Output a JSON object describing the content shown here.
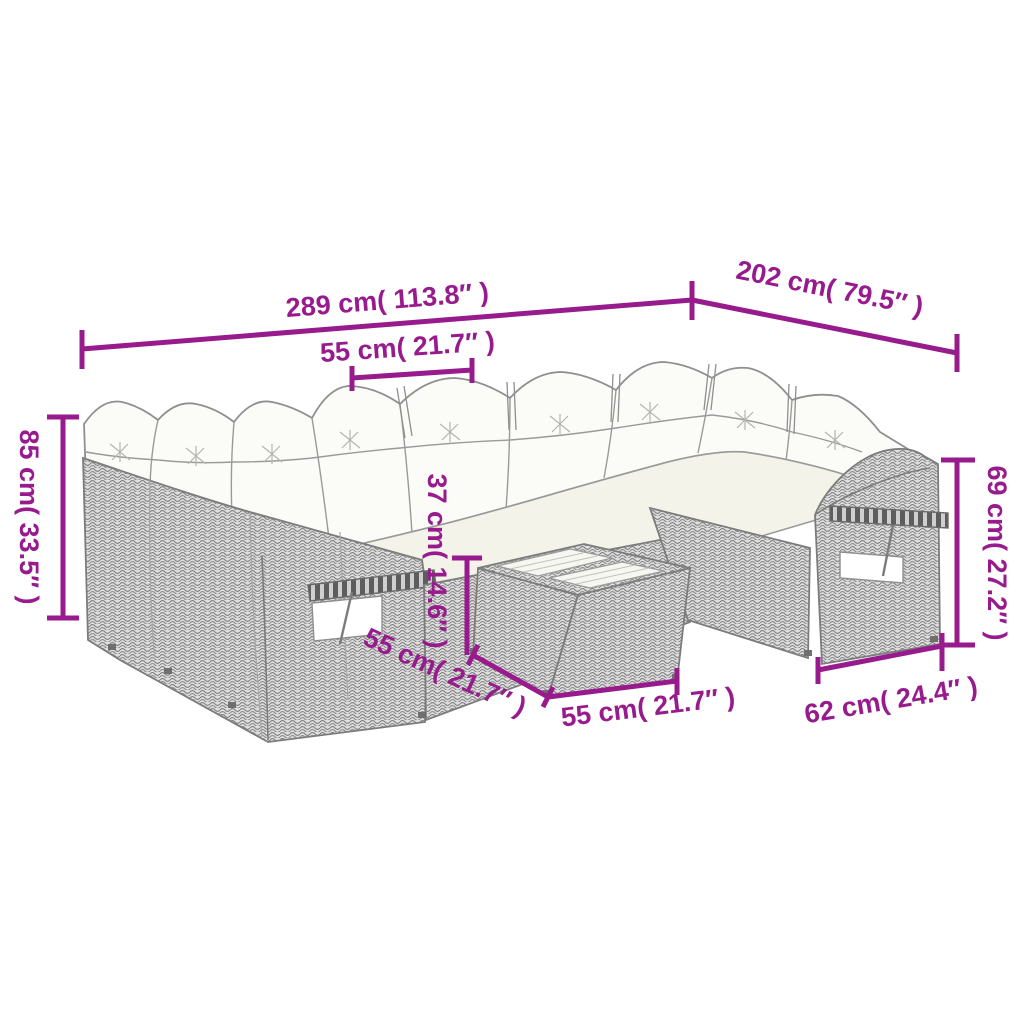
{
  "figure": {
    "type": "product-dimension-diagram",
    "subject": "poly rattan garden lounge sofa set with cushions, fold-out trays and cube table",
    "accent_color": "#981b8e",
    "line_art_color": "#8f8f8f",
    "background_color": "#ffffff"
  },
  "dimensions": [
    {
      "id": "total-width",
      "label": "289 cm( 113.8″ )"
    },
    {
      "id": "total-depth",
      "label": "202 cm( 79.5″ )"
    },
    {
      "id": "seat-width",
      "label": "55 cm( 21.7″ )"
    },
    {
      "id": "overall-height",
      "label": "85 cm( 33.5″ )"
    },
    {
      "id": "table-height",
      "label": "37 cm( 14.6″ )"
    },
    {
      "id": "table-depth",
      "label": "55 cm( 21.7″ )"
    },
    {
      "id": "table-width",
      "label": "55 cm( 21.7″ )"
    },
    {
      "id": "seat-depth",
      "label": "62 cm( 24.4″ )"
    },
    {
      "id": "armrest-height",
      "label": "69 cm( 27.2″ )"
    }
  ]
}
